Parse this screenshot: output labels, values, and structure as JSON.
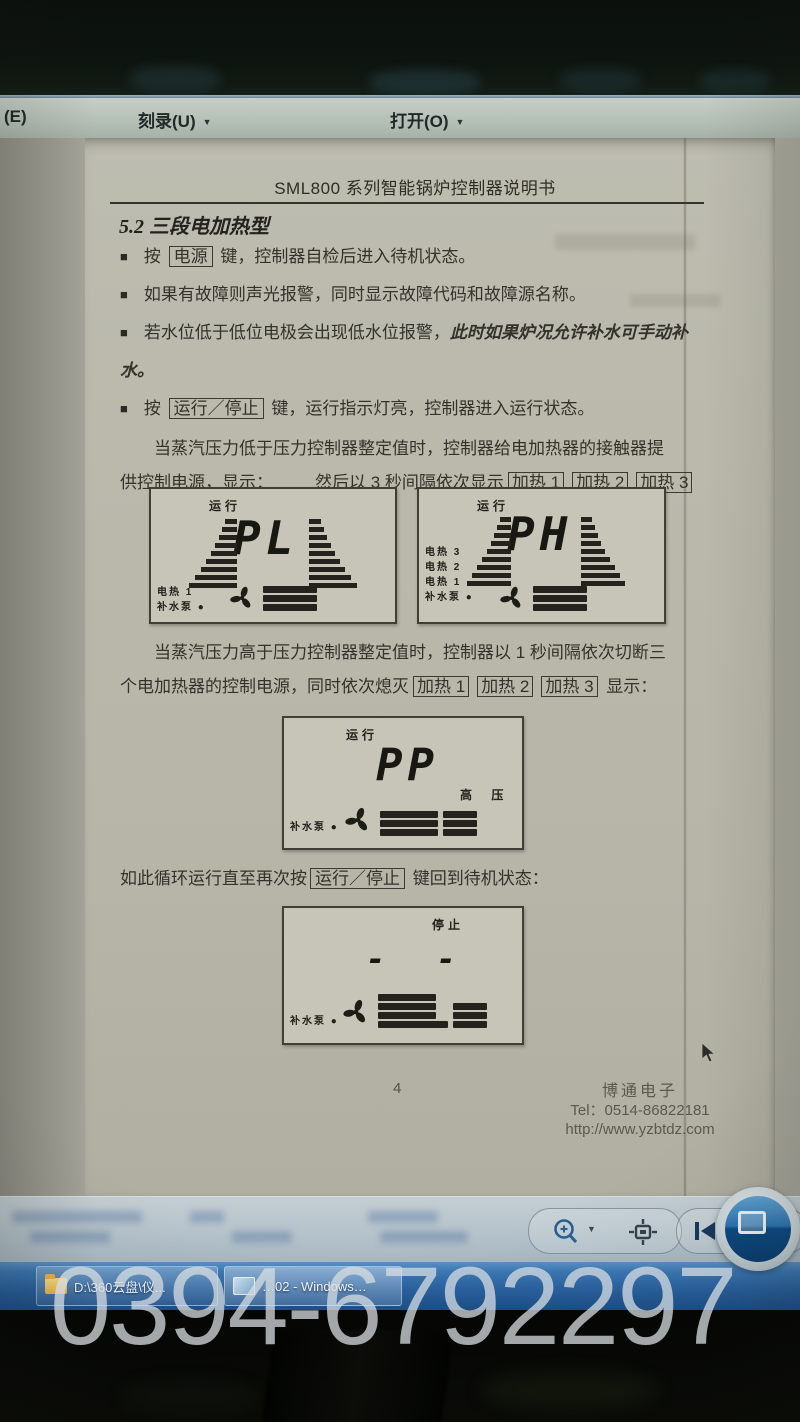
{
  "watermark": "0394-6792297",
  "menu_bar": {
    "item_e": "(E)",
    "item_burn": "刻录(U)",
    "item_open": "打开(O)",
    "caret": "▼"
  },
  "document": {
    "title": "SML800 系列智能锅炉控制器说明书",
    "section": "5.2 三段电加热型",
    "bullet_glyph": "■",
    "bullet1": {
      "pre": "按 ",
      "key": "电源",
      "post": " 键，控制器自检后进入待机状态。"
    },
    "bullet2": {
      "text": "如果有故障则声光报警，同时显示故障代码和故障源名称。"
    },
    "bullet3": {
      "pre": "若水位低于低位电极会出现低水位报警，",
      "em": "此时如果炉况允许补水可手动补水。"
    },
    "bullet4": {
      "pre": "按 ",
      "key": "运行／停止",
      "post": " 键，运行指示灯亮，控制器进入运行状态。"
    },
    "para1": {
      "line1": "当蒸汽压力低于压力控制器整定值时，控制器给电加热器的接触器提",
      "line2_pre": "供控制电源，显示：",
      "line2_mid": "然后以 3 秒间隔依次显示"
    },
    "heat": {
      "h1": "加热 1",
      "h2": "加热 2",
      "h3": "加热 3"
    },
    "para2": {
      "line1": "当蒸汽压力高于压力控制器整定值时，控制器以 1 秒间隔依次切断三",
      "line2_pre": "个电加热器的控制电源，同时依次熄灭",
      "line2_post": "显示："
    },
    "cycle": {
      "pre": "如此循环运行直至再次按",
      "key": "运行／停止",
      "post": " 键回到待机状态："
    },
    "lcds": [
      {
        "status": "运行",
        "value": "PL",
        "labels": [
          "电热 1",
          "补水泵"
        ],
        "dot": "●"
      },
      {
        "status": "运行",
        "value": "PH",
        "labels": [
          "电热 3",
          "电热 2",
          "电热 1",
          "补水泵"
        ],
        "dot": "●"
      },
      {
        "status": "运行",
        "value": "PP",
        "side_label": "高  压",
        "labels": [
          "补水泵"
        ],
        "dot": "●"
      },
      {
        "status": "停止",
        "value": "- -",
        "labels": [
          "补水泵"
        ],
        "dot": "●"
      }
    ],
    "footer": {
      "page_number": "4",
      "company": "博通电子",
      "tel": "Tel：0514-86822181",
      "url": "http://www.yzbtdz.com"
    }
  },
  "viewer_toolbar": {
    "zoom_caret": "▼",
    "icons": {
      "zoom": "magnifier-plus-icon",
      "actual_size": "actual-size-icon",
      "previous": "previous-frame-icon",
      "slideshow": "slideshow-play-icon"
    }
  },
  "taskbar": {
    "button1": "D:\\360云盘\\仪...",
    "button2": "…02 - Windows…"
  }
}
